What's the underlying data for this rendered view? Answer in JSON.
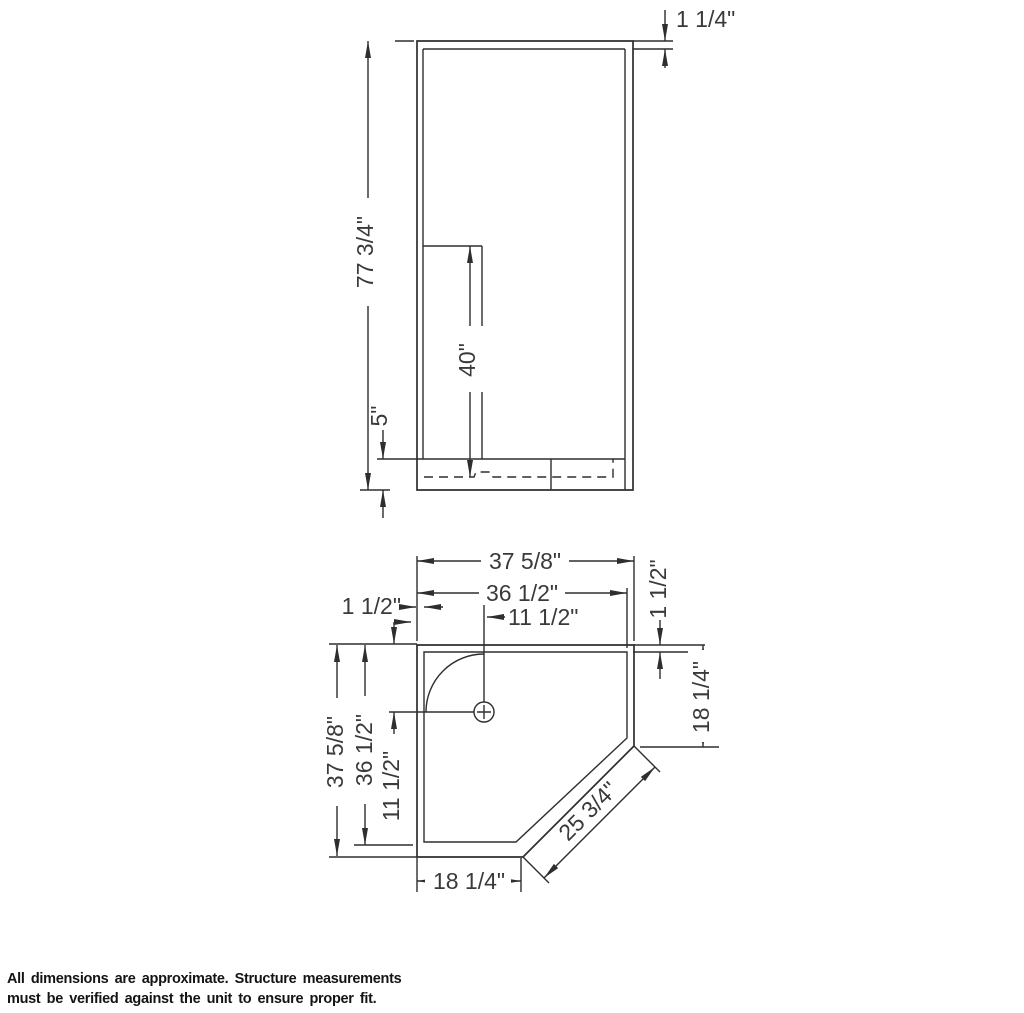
{
  "elevation": {
    "overall_height": "77 3/4\"",
    "top_frame": "1 1/4\"",
    "back_panel_height": "40\"",
    "base_height": "5\""
  },
  "plan": {
    "outer_width": "37 5/8\"",
    "inner_width": "36 1/2\"",
    "drain_from_left": "11 1/2\"",
    "left_flange": "1 1/2\"",
    "outer_depth": "37 5/8\"",
    "inner_depth": "36 1/2\"",
    "drain_from_back": "11 1/2\"",
    "right_flange": "1 1/2\"",
    "right_wall_length": "18 1/4\"",
    "front_wall_length": "18 1/4\"",
    "diagonal_length": "25 3/4\""
  },
  "footer": {
    "line1": "All dimensions are approximate. Structure measurements",
    "line2": "must be verified against the unit to ensure proper fit."
  },
  "colors": {
    "line": "#2e2e2e",
    "label": "#3a3a3a",
    "footer_text": "#141414",
    "background": "#ffffff"
  }
}
